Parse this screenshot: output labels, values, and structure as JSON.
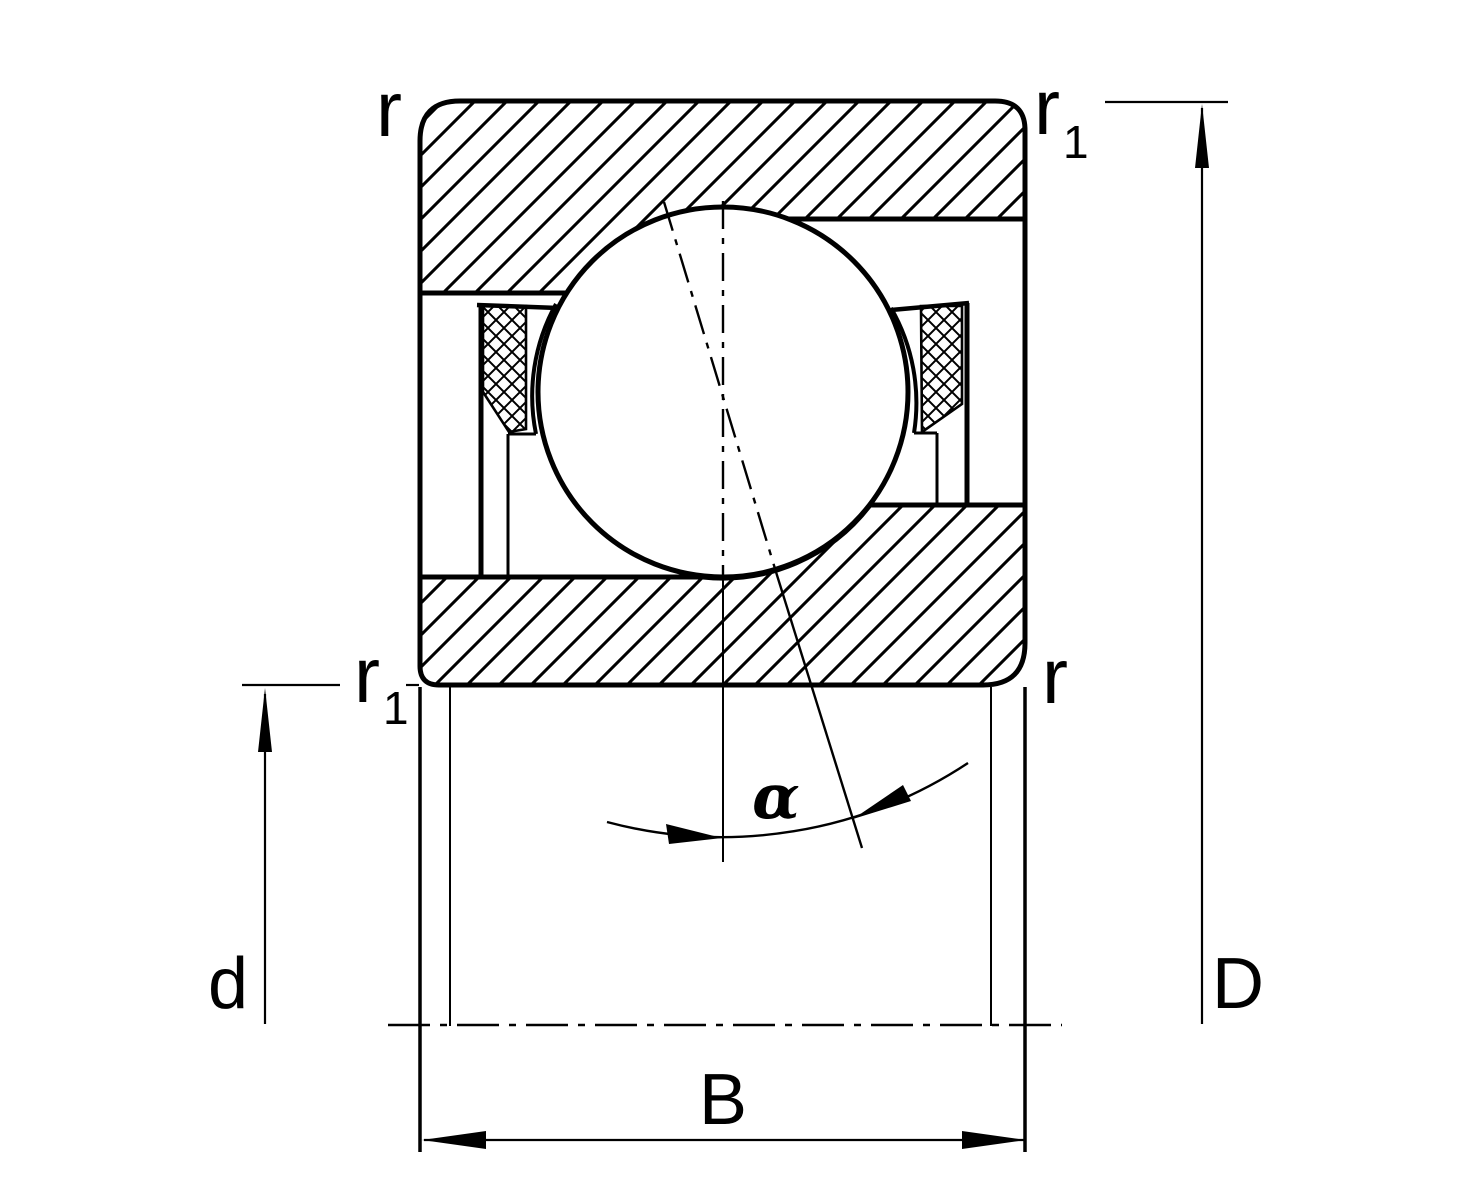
{
  "diagram": {
    "title": "Angular contact ball bearing cross-section dimension drawing",
    "colors": {
      "line": "#000000",
      "background": "#ffffff"
    },
    "labels": {
      "chamfer_top_left": "r",
      "chamfer_top_right_base": "r",
      "chamfer_top_right_sub": "1",
      "chamfer_mid_left_base": "r",
      "chamfer_mid_left_sub": "1",
      "chamfer_mid_right": "r",
      "bore_diameter": "d",
      "outside_diameter": "D",
      "width": "B",
      "contact_angle": "α"
    }
  }
}
